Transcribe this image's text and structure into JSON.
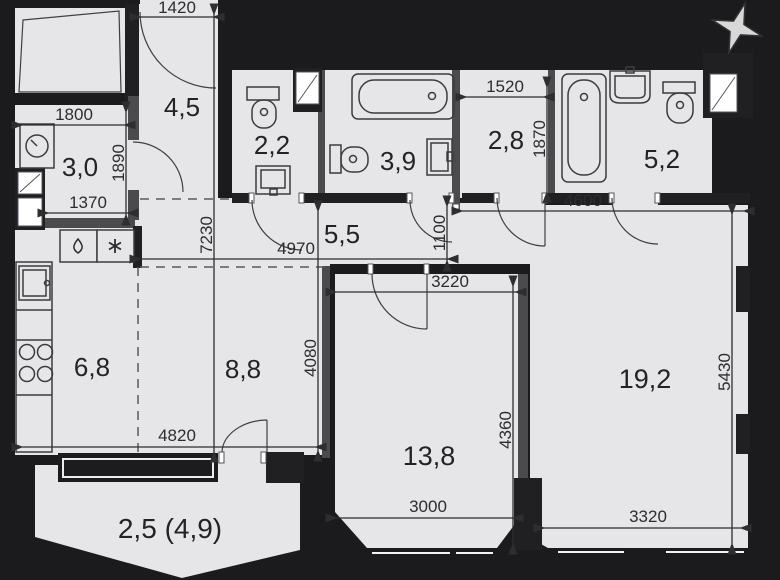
{
  "plan": {
    "type": "apartment-floor-plan",
    "rooms": [
      {
        "name": "laundry-room",
        "area_label": "3,0"
      },
      {
        "name": "hallway",
        "area_label": "4,5"
      },
      {
        "name": "wc",
        "area_label": "2,2"
      },
      {
        "name": "bathroom",
        "area_label": "3,9"
      },
      {
        "name": "wardrobe",
        "area_label": "2,8"
      },
      {
        "name": "bathroom-2",
        "area_label": "5,2"
      },
      {
        "name": "corridor",
        "area_label": "5,5"
      },
      {
        "name": "kitchen",
        "area_label": "6,8"
      },
      {
        "name": "living-area",
        "area_label": "8,8"
      },
      {
        "name": "bedroom",
        "area_label": "13,8"
      },
      {
        "name": "living-room",
        "area_label": "19,2"
      },
      {
        "name": "balcony",
        "area_label": "2,5 (4,9)"
      }
    ],
    "dimensions": [
      {
        "id": "entry-width",
        "value": "1420"
      },
      {
        "id": "laundry-width",
        "value": "1800"
      },
      {
        "id": "laundry-height",
        "value": "1890"
      },
      {
        "id": "laundry-bottom",
        "value": "1370"
      },
      {
        "id": "wardrobe-width",
        "value": "1520"
      },
      {
        "id": "wardrobe-height",
        "value": "1870"
      },
      {
        "id": "livingroom-top",
        "value": "4600"
      },
      {
        "id": "corridor-length",
        "value": "4970"
      },
      {
        "id": "corridor-nook",
        "value": "1100"
      },
      {
        "id": "plan-height",
        "value": "7230"
      },
      {
        "id": "bedroom-top",
        "value": "3220"
      },
      {
        "id": "living-area-height",
        "value": "4080"
      },
      {
        "id": "bedroom-height",
        "value": "4360"
      },
      {
        "id": "bedroom-bottom",
        "value": "3000"
      },
      {
        "id": "livingroom-height",
        "value": "5430"
      },
      {
        "id": "livingroom-bottom",
        "value": "3320"
      },
      {
        "id": "kitchen-bottom",
        "value": "4820"
      }
    ],
    "icons": {
      "compass": "compass-star-icon",
      "water": "droplet-icon",
      "fridge": "snowflake-icon",
      "shower": "shower-tray-icon",
      "shaft": "duct-shaft-icon"
    },
    "colors": {
      "floor": "#e6e6e8",
      "walls": "#202023",
      "background": "#161616",
      "text": "#232323"
    }
  }
}
